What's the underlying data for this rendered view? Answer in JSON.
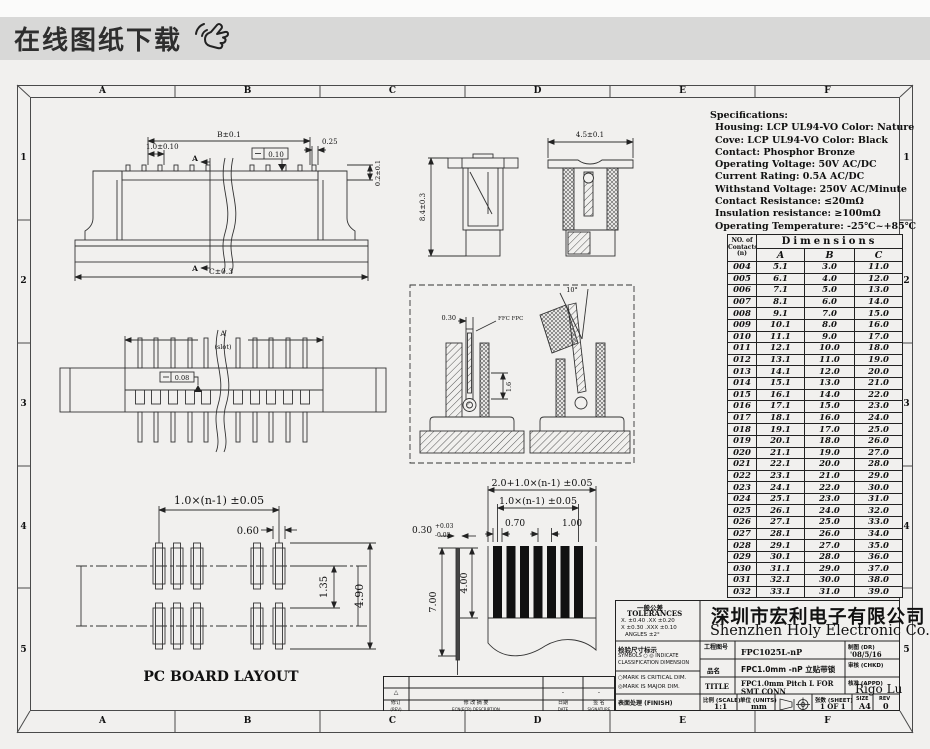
{
  "banner": {
    "title": "在线图纸下载"
  },
  "frame": {
    "columns": [
      "A",
      "B",
      "C",
      "D",
      "E",
      "F"
    ],
    "rows": [
      "1",
      "2",
      "3",
      "4",
      "5"
    ]
  },
  "specs": {
    "title": "Specifications:",
    "lines": [
      "Housing: LCP UL94-VO Color: Nature",
      "Cove: LCP UL94-VO Color: Black",
      "Contact: Phosphor Bronze",
      "Operating Voltage: 50V AC/DC",
      "Current Rating: 0.5A AC/DC",
      "Withstand Voltage: 250V AC/Minute",
      "Contact Resistance: ≤20mΩ",
      "Insulation resistance: ≥100mΩ",
      "Operating Temperature: -25℃~+85℃"
    ]
  },
  "dim_table": {
    "corner_header": [
      "NO. of",
      "Contacts",
      "(n)"
    ],
    "group_header": "Dimensions",
    "columns": [
      "A",
      "B",
      "C"
    ],
    "rows": [
      [
        "004",
        "5.1",
        "3.0",
        "11.0"
      ],
      [
        "005",
        "6.1",
        "4.0",
        "12.0"
      ],
      [
        "006",
        "7.1",
        "5.0",
        "13.0"
      ],
      [
        "007",
        "8.1",
        "6.0",
        "14.0"
      ],
      [
        "008",
        "9.1",
        "7.0",
        "15.0"
      ],
      [
        "009",
        "10.1",
        "8.0",
        "16.0"
      ],
      [
        "010",
        "11.1",
        "9.0",
        "17.0"
      ],
      [
        "011",
        "12.1",
        "10.0",
        "18.0"
      ],
      [
        "012",
        "13.1",
        "11.0",
        "19.0"
      ],
      [
        "013",
        "14.1",
        "12.0",
        "20.0"
      ],
      [
        "014",
        "15.1",
        "13.0",
        "21.0"
      ],
      [
        "015",
        "16.1",
        "14.0",
        "22.0"
      ],
      [
        "016",
        "17.1",
        "15.0",
        "23.0"
      ],
      [
        "017",
        "18.1",
        "16.0",
        "24.0"
      ],
      [
        "018",
        "19.1",
        "17.0",
        "25.0"
      ],
      [
        "019",
        "20.1",
        "18.0",
        "26.0"
      ],
      [
        "020",
        "21.1",
        "19.0",
        "27.0"
      ],
      [
        "021",
        "22.1",
        "20.0",
        "28.0"
      ],
      [
        "022",
        "23.1",
        "21.0",
        "29.0"
      ],
      [
        "023",
        "24.1",
        "22.0",
        "30.0"
      ],
      [
        "024",
        "25.1",
        "23.0",
        "31.0"
      ],
      [
        "025",
        "26.1",
        "24.0",
        "32.0"
      ],
      [
        "026",
        "27.1",
        "25.0",
        "33.0"
      ],
      [
        "027",
        "28.1",
        "26.0",
        "34.0"
      ],
      [
        "028",
        "29.1",
        "27.0",
        "35.0"
      ],
      [
        "029",
        "30.1",
        "28.0",
        "36.0"
      ],
      [
        "030",
        "31.1",
        "29.0",
        "37.0"
      ],
      [
        "031",
        "32.1",
        "30.0",
        "38.0"
      ],
      [
        "032",
        "33.1",
        "31.0",
        "39.0"
      ]
    ]
  },
  "front_view": {
    "dim_b": "B±0.1",
    "dim_pitch": "1.0±0.10",
    "flatness": "0.10",
    "dim_end": "0.25",
    "dim_height": "0.2±0.1",
    "dim_c": "C±0.3",
    "section": "A"
  },
  "plan_view": {
    "dim_a": "A",
    "dim_a_note": "(slot)",
    "flatness": "0.08"
  },
  "pcb_layout": {
    "dim_span": "1.0×(n-1) ±0.05",
    "dim_pad_width": "0.60",
    "dim_inner": "1.35",
    "dim_overall": "4.90",
    "title": "PC BOARD LAYOUT"
  },
  "side_views": {
    "dim_height": "8.4±0.3",
    "dim_width": "4.5±0.1"
  },
  "detail_views": {
    "dim_tip": "0.30",
    "cable_note": "FFC FPC",
    "dim_depth": "1.6",
    "dim_angle": "10°"
  },
  "fpc_drawing": {
    "dim_overall": "2.0+1.0×(n-1) ±0.05",
    "dim_span": "1.0×(n-1) ±0.05",
    "dim_pad": "0.70",
    "dim_pitch": "1.00",
    "dim_thickness": "0.30",
    "dim_thickness_tol_up": "+0.03",
    "dim_thickness_tol_dn": "-0.02",
    "dim_len1": "7.00",
    "dim_len2": "4.00"
  },
  "title_block": {
    "tol_title_cn": "一般公差",
    "tol_title_en": "TOLERANCES",
    "tol_line1": "X. ±0.40   .XX ±0.20",
    "tol_line2": "X ±0.30   .XXX ±0.10",
    "tol_line3": "ANGLES    ±2°",
    "insp_title": "检验尺寸标示",
    "insp_line1": "SYMBOLS ○ ◎ INDICATE",
    "insp_line2": "CLASSIFICATION DIMENSION",
    "mark1": "○MARK IS CRITICAL DIM.",
    "mark2": "◎MARK IS MAJOR DIM.",
    "finish_label": "表面处理 (FINISH)",
    "company_cn": "深圳市宏利电子有限公司",
    "company_en": "Shenzhen Holy Electronic Co.,Ltd",
    "drawing_no_label": "工程图号",
    "drawing_no": "FPC1025L-nP",
    "product_label": "品名",
    "product": "FPC1.0mm -nP 立贴带锁",
    "title_label": "TITLE",
    "title_line1": "FPC1.0mm Pitch L FOR",
    "title_line2": "SMT CONN",
    "dr_label": "制图 (DR)",
    "dr_value": "'08/5/16",
    "chkd_label": "审核 (CHKD)",
    "chkd_value": "",
    "appd_label": "核准 (APPD)",
    "appd_value": "Rigo Lu",
    "scale_label": "比例 (SCALE)",
    "scale_value": "1:1",
    "units_label": "单位 (UNITS)",
    "units_value": "mm",
    "sheet_label": "张数 (SHEET)",
    "sheet_value": "1 OF 1",
    "size_label": "SIZE",
    "size_value": "A4",
    "rev_label": "REV",
    "rev_value": "0"
  },
  "revision_table": {
    "rev_col_cn": "修订",
    "rev_col_en": "(REV)",
    "desc_col_cn": "修 改 摘 要",
    "desc_col_en": "ECN(ECR) DESCRIPTION",
    "date_col_cn": "日期",
    "date_col_en": "DATE",
    "sign_col_cn": "签 名",
    "sign_col_en": "SIGNATURE",
    "row_rev": "△",
    "row_date": "-",
    "row_sign": "-"
  }
}
